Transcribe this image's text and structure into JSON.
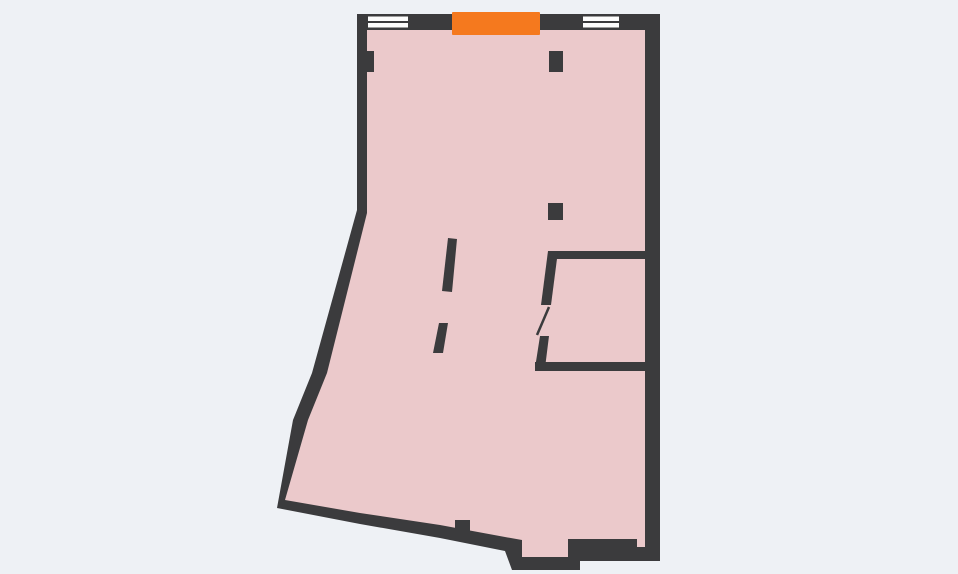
{
  "app": {
    "name": "floor-plan-viewer",
    "view": "apartment-floor-plan"
  },
  "colors": {
    "background": "#eef1f5",
    "floor": "#ebc9cb",
    "wall": "#3b3b3d",
    "window_fill": "#fcfcfc",
    "highlight": "#f5791e"
  },
  "floorplan": {
    "canvas": {
      "width": 958,
      "height": 574
    },
    "outer_wall": {
      "name": "outer-wall-outline",
      "points": "357,14 660,14 660,561 580,561 580,570 512,570 505,551 440,538 360,524 277,508 293,420 312,373 357,210"
    },
    "floor": {
      "name": "floor-area",
      "points": "367,30 645,30 645,547 637,547 637,539 568,539 568,557 522,557 522,540 505,537 440,525 360,513 285,500 308,420 327,373 367,213"
    },
    "windows": [
      {
        "name": "window-top-left",
        "x": 368,
        "y": 16.5,
        "width": 40,
        "height": 11
      },
      {
        "name": "window-top-right",
        "x": 583,
        "y": 16.5,
        "width": 36,
        "height": 11
      }
    ],
    "highlighted_segment": {
      "name": "highlighted-opening-marker",
      "x": 452,
      "y": 12,
      "width": 88,
      "height": 23
    },
    "interior_walls": [
      {
        "name": "subroom-top-wall",
        "points": "548,251 645,251 645,259 548,259"
      },
      {
        "name": "subroom-bottom-wall",
        "points": "535,362 645,362 645,371 535,371"
      },
      {
        "name": "subroom-door-jamb-upper",
        "points": "548,251 558,251 551,305 541,305"
      },
      {
        "name": "subroom-door-jamb-lower",
        "points": "540,336 549,336 545,368 535,368"
      },
      {
        "name": "partition-stub-upper",
        "points": "448,238 457,239 452,292 442,291"
      },
      {
        "name": "partition-stub-lower",
        "points": "439,323 448,323 443,353 433,353"
      },
      {
        "name": "column-top",
        "points": "549,51 563,51 563,72 549,72"
      },
      {
        "name": "column-middle",
        "points": "548,203 563,203 563,220 548,220"
      },
      {
        "name": "left-wall-stub",
        "points": "365,51 374,51 374,72 365,72"
      },
      {
        "name": "bottom-wall-stub",
        "points": "455,520 470,520 470,538 455,538"
      }
    ],
    "door_leaf": {
      "name": "door-swing-leaf",
      "x1": 549,
      "y1": 307,
      "x2": 537,
      "y2": 335,
      "stroke_width": 2.5
    }
  }
}
